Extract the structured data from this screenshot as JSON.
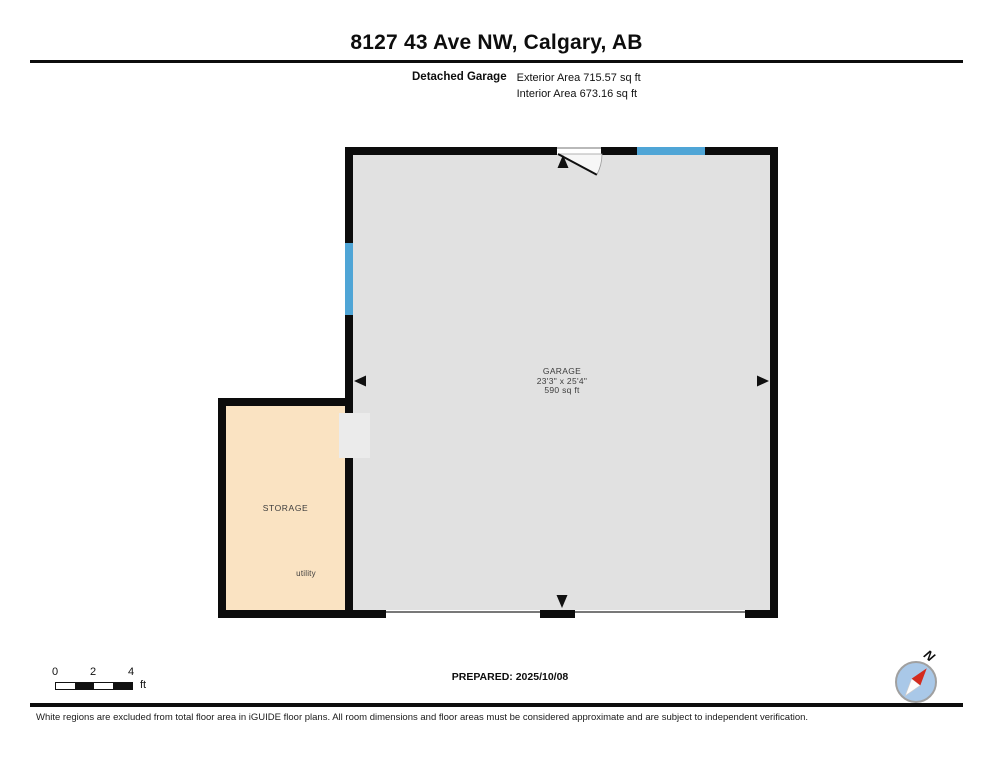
{
  "header": {
    "title": "8127 43 Ave NW, Calgary, AB",
    "plan_type_label": "Detached Garage",
    "exterior_area": "Exterior Area 715.57 sq ft",
    "interior_area": "Interior Area 673.16 sq ft"
  },
  "floorplan": {
    "rooms": [
      {
        "name": "GARAGE",
        "dimensions": "23'3\" x 25'4\"",
        "area": "590 sq ft",
        "floor_color": "#e1e1e1"
      },
      {
        "name": "STORAGE",
        "feature_label": "utility",
        "floor_color": "#fae3c2"
      }
    ],
    "wall_color": "#0c0c0c",
    "window_color": "#4fa5d6"
  },
  "scale_bar": {
    "ticks": [
      "0",
      "2",
      "4"
    ],
    "unit": "ft"
  },
  "prepared": {
    "label": "PREPARED: 2025/10/08"
  },
  "compass": {
    "north_label": "N",
    "needle_color": "#d42b1e",
    "face_color": "#a9c8e8"
  },
  "disclaimer": "White regions are excluded from total floor area in iGUIDE floor plans. All room dimensions and floor areas must be considered approximate and are subject to independent verification."
}
